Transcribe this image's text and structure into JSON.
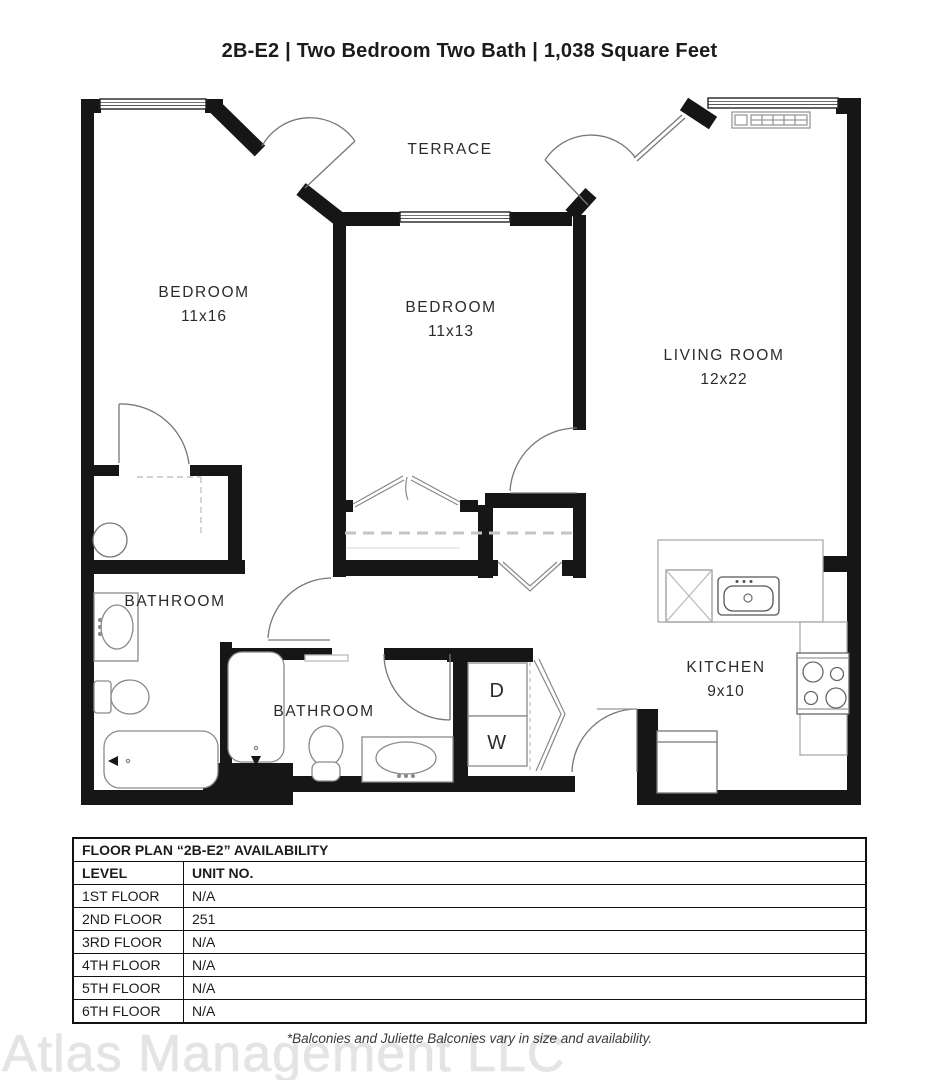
{
  "title": "2B-E2 | Two Bedroom Two Bath | 1,038 Square Feet",
  "floor_plan": {
    "terrace_label": "TERRACE",
    "bedroom1": {
      "label": "BEDROOM",
      "dims": "11x16"
    },
    "bedroom2": {
      "label": "BEDROOM",
      "dims": "11x13"
    },
    "living_room": {
      "label": "LIVING ROOM",
      "dims": "12x22"
    },
    "kitchen": {
      "label": "KITCHEN",
      "dims": "9x10"
    },
    "bathroom1_label": "BATHROOM",
    "bathroom2_label": "BATHROOM",
    "dryer_label": "D",
    "washer_label": "W"
  },
  "availability_table": {
    "title": "FLOOR PLAN “2B-E2” AVAILABILITY",
    "columns": [
      "LEVEL",
      "UNIT NO."
    ],
    "rows": [
      {
        "level": "1ST FLOOR",
        "unit": "N/A"
      },
      {
        "level": "2ND FLOOR",
        "unit": "251"
      },
      {
        "level": "3RD FLOOR",
        "unit": "N/A"
      },
      {
        "level": "4TH FLOOR",
        "unit": "N/A"
      },
      {
        "level": "5TH FLOOR",
        "unit": "N/A"
      },
      {
        "level": "6TH FLOOR",
        "unit": "N/A"
      }
    ]
  },
  "footnote": "*Balconies and Juliette Balconies vary in size and availability.",
  "watermark": "Atlas Management LLC",
  "colors": {
    "wall": "#161616",
    "fixture": "#8a8a8a",
    "dash": "#c4c4c4"
  }
}
